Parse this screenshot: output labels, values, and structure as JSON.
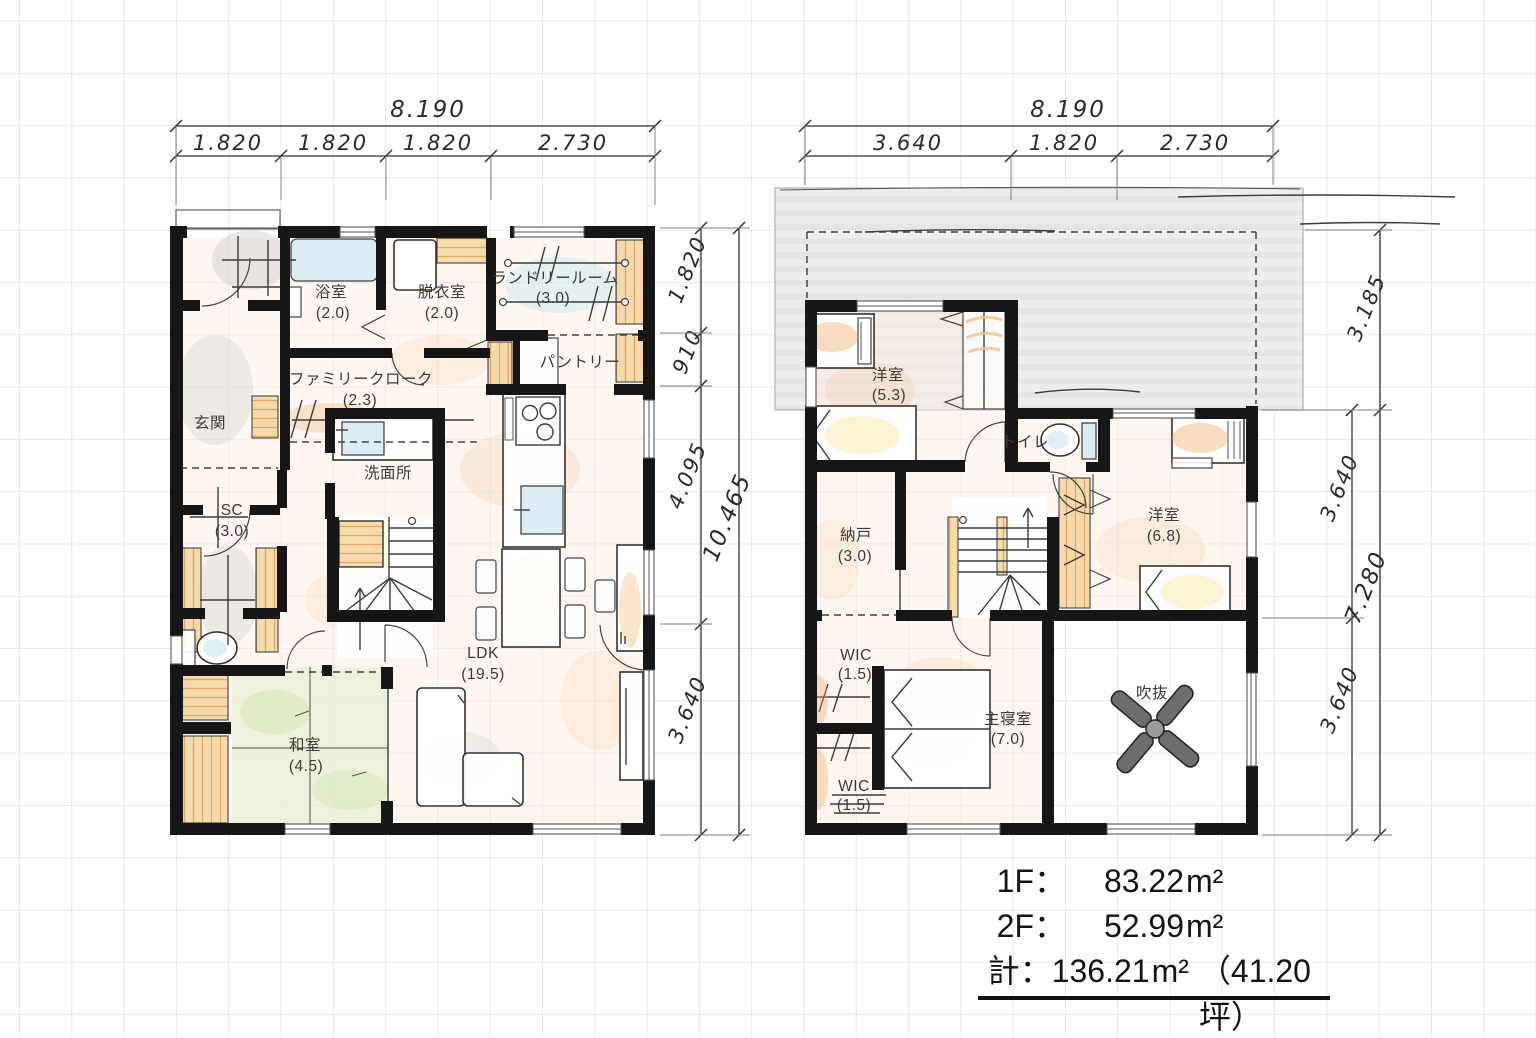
{
  "floor1": {
    "dim_top": {
      "total": "8.190",
      "seg1": "1.820",
      "seg2": "1.820",
      "seg3": "1.820",
      "seg4": "2.730"
    },
    "dim_side": {
      "seg1": "1.820",
      "seg2": "910",
      "seg3": "4.095",
      "seg4": "3.640",
      "total": "10.465"
    },
    "rooms": {
      "bath": {
        "name": "浴室",
        "size": "(2.0)"
      },
      "dressing": {
        "name": "脱衣室",
        "size": "(2.0)"
      },
      "laundry": {
        "name": "ランドリールーム",
        "size": "(3.0)"
      },
      "pantry": {
        "name": "パントリー"
      },
      "family_closet": {
        "name": "ファミリークローク",
        "size": "(2.3)"
      },
      "entrance": {
        "name": "玄関"
      },
      "washroom": {
        "name": "洗面所"
      },
      "shoe_closet": {
        "name": "SC",
        "size": "(3.0)"
      },
      "japanese_room": {
        "name": "和室",
        "size": "(4.5)"
      },
      "ldk": {
        "name": "LDK",
        "size": "(19.5)"
      }
    }
  },
  "floor2": {
    "dim_top": {
      "total": "8.190",
      "seg1": "3.640",
      "seg2": "1.820",
      "seg3": "2.730"
    },
    "dim_side": {
      "outer1": "3.185",
      "outer2": "7.280",
      "inner1": "3.640",
      "inner2": "3.640"
    },
    "rooms": {
      "bedroom_a": {
        "name": "洋室",
        "size": "(5.3)"
      },
      "toilet": {
        "name": "トイレ"
      },
      "storage": {
        "name": "納戸",
        "size": "(3.0)"
      },
      "bedroom_b": {
        "name": "洋室",
        "size": "(6.8)"
      },
      "wic_upper": {
        "name": "WIC",
        "size": "(1.5)"
      },
      "master_bedroom": {
        "name": "主寝室",
        "size": "(7.0)"
      },
      "wic_lower": {
        "name": "WIC",
        "size": "(1.5)"
      },
      "void": {
        "name": "吹抜"
      }
    }
  },
  "summary": {
    "rows": [
      {
        "label": "1F",
        "colon": "：",
        "value": "83.22",
        "unit": "m²"
      },
      {
        "label": "2F",
        "colon": "：",
        "value": "52.99",
        "unit": "m²"
      },
      {
        "label": "計",
        "colon": "：",
        "value": "136.21",
        "unit": "m²",
        "extra": "（41.20坪）"
      }
    ]
  },
  "colors": {
    "wall": "#161616",
    "room_tint": "#fbeee3",
    "tatami": "#e4eecf",
    "water": "#d6eaf2",
    "closet": "#f7d7a4",
    "roof": "#eaeaea",
    "grid": "#e5e8ea"
  }
}
